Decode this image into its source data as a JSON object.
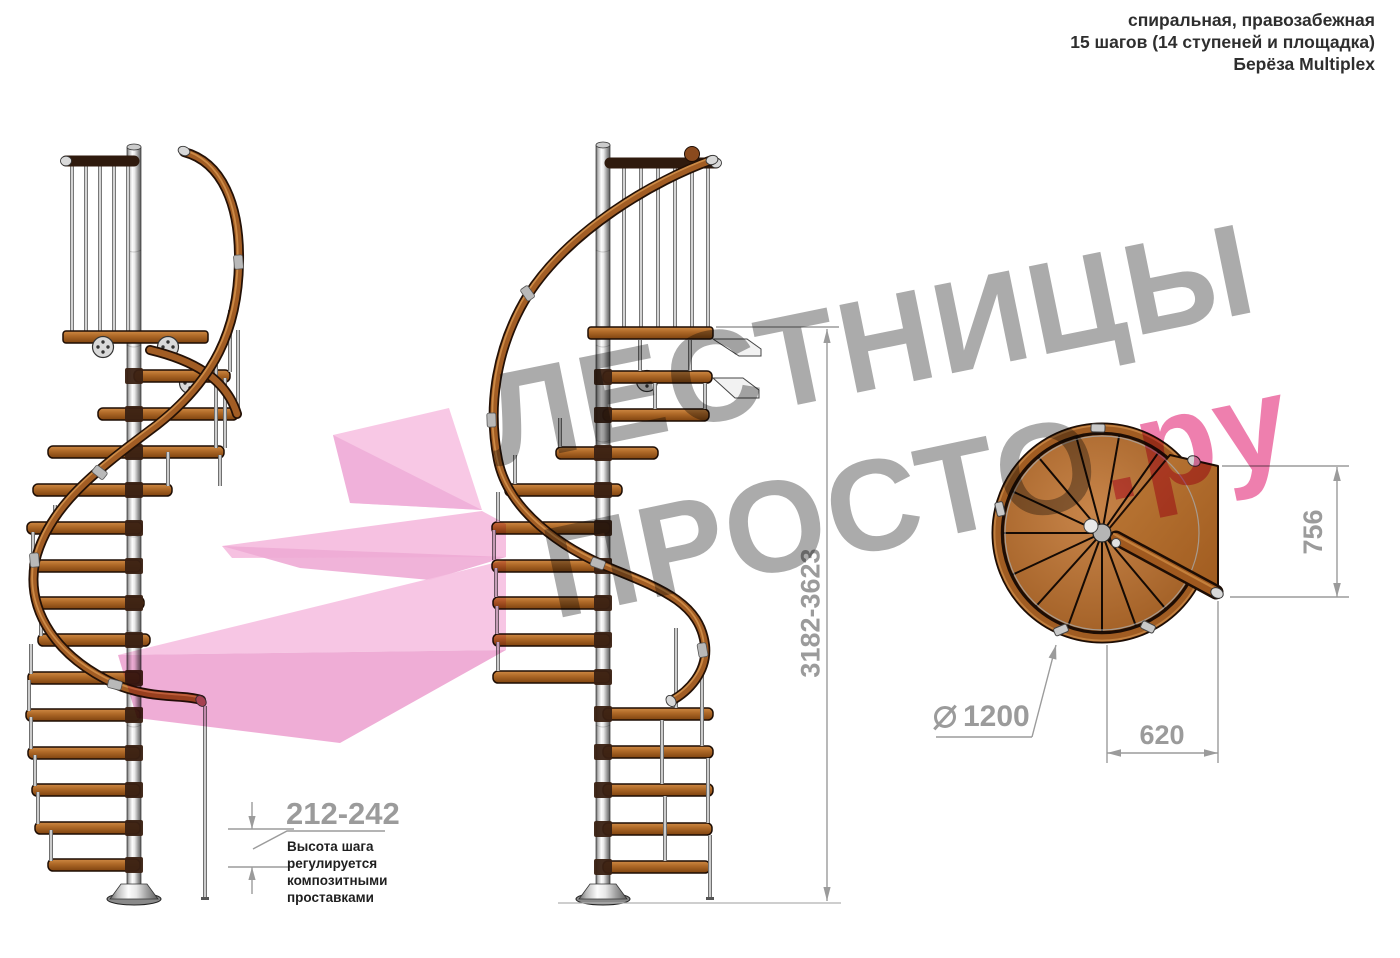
{
  "header": {
    "line1": "спиральная, правозабежная",
    "line2": "15 шагов (14 ступеней и площадка)",
    "line3": "Берёза Multiplex"
  },
  "watermark": {
    "word1": "ЛЕСТНИЦЫ",
    "word2": "ПРОСТО",
    "word2_suffix": ".ру",
    "gray_color": "#ababab",
    "pink_color": "#ee7fae"
  },
  "dimensions": {
    "total_height": "3182-3623",
    "step_height": "212-242",
    "step_height_note_lines": [
      "Высота шага",
      "регулируется",
      "композитными",
      "проставками"
    ],
    "landing_depth": "756",
    "landing_width": "620",
    "diameter": "1200"
  },
  "colors": {
    "wood": "#a85f22",
    "rail_outline": "#241106",
    "metal": "#d9d9d9",
    "dimension_gray": "#9b9b9b",
    "logo_pink_light": "#f6c0e1",
    "logo_pink_dark": "#eda4d1"
  }
}
